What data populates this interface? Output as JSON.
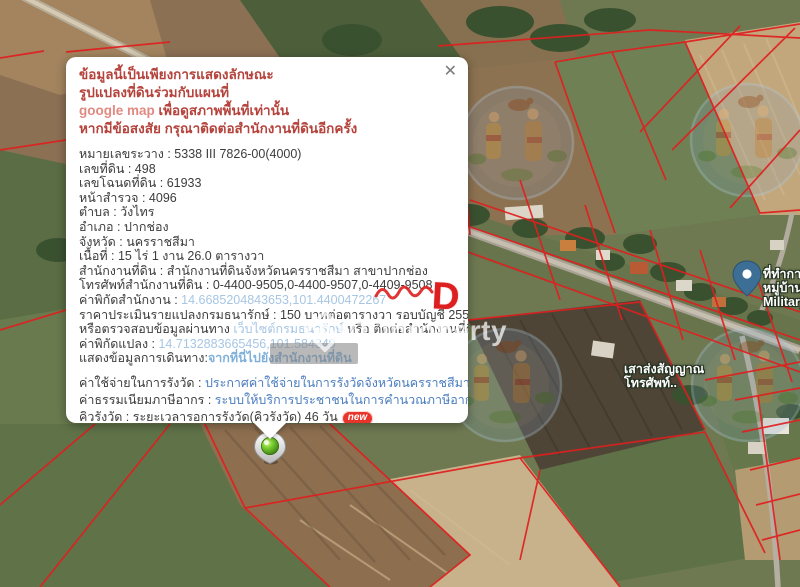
{
  "popup": {
    "close_label": "✕",
    "blocks": [
      {
        "name": "warning",
        "lines": [
          [
            {
              "t": "ข้อมูลนี้เป็นเพียงการแสดงลักษณะ",
              "s": "red"
            }
          ],
          [
            {
              "t": "รูปแปลงที่ดินร่วมกับแผนที่",
              "s": "red"
            }
          ],
          [
            {
              "t": "google map ",
              "s": "red-light"
            },
            {
              "t": "เพื่อดูสภาพพื้นที่เท่านั้น",
              "s": "red"
            }
          ],
          [
            {
              "t": "หากมีข้อสงสัย กรุณาติดต่อสำนักงานที่ดินอีกครั้ง",
              "s": "red"
            }
          ]
        ]
      },
      {
        "name": "details",
        "lines": [
          [
            {
              "t": "หมายเลขระวาง : 5338 III 7826-00(4000)"
            }
          ],
          [
            {
              "t": "เลขที่ดิน : 498"
            }
          ],
          [
            {
              "t": "เลขโฉนดที่ดิน : 61933"
            }
          ],
          [
            {
              "t": "หน้าสำรวจ : 4096"
            }
          ],
          [
            {
              "t": "ตำบล : วังไทร"
            }
          ],
          [
            {
              "t": "อำเภอ : ปากช่อง"
            }
          ],
          [
            {
              "t": "จังหวัด : นครราชสีมา"
            }
          ],
          [
            {
              "t": "เนื้อที่ : 15 ไร่ 1 งาน 26.0 ตารางวา"
            }
          ],
          [
            {
              "t": "สำนักงานที่ดิน : สำนักงานที่ดินจังหวัดนครราชสีมา สาขาปากช่อง"
            }
          ],
          [
            {
              "t": "โทรศัพท์สำนักงานที่ดิน : 0-4400-9505,0-4400-9507,0-4409-9508"
            }
          ],
          [
            {
              "t": "ค่าพิกัดสำนักงาน : "
            },
            {
              "t": "14.6685204843653,101.4400472267",
              "s": "link-light"
            }
          ],
          [
            {
              "t": "ราคาประเมินรายแปลงกรมธนารักษ์ : 150 บาทต่อตารางวา รอบบัญชี 2559-2562"
            }
          ],
          [
            {
              "t": "หรือตรวจสอบข้อมูลผ่านทาง "
            },
            {
              "t": "เว็บไซต์กรมธนารักษ์",
              "s": "link-light"
            },
            {
              "t": " หรือ ติดต่อสำนักงานที่ดิน"
            }
          ],
          [
            {
              "t": "ค่าพิกัดแปลง : "
            },
            {
              "t": "14.7132883665456,101.584349",
              "s": "link-light"
            }
          ],
          [
            {
              "t": "แสดงข้อมูลการเดินทาง:"
            },
            {
              "t": "จากที่นี่ไปยังสำนักงานที่ดิน",
              "s": "link-mid"
            }
          ]
        ]
      },
      {
        "name": "actions",
        "lines": [
          [
            {
              "t": "ค่าใช้จ่ายในการรังวัด : "
            },
            {
              "t": "ประกาศค่าใช้จ่ายในการรังวัดจังหวัดนครราชสีมา",
              "s": "link-blue"
            },
            {
              "t": "new",
              "s": "badge"
            }
          ],
          [
            {
              "t": "ค่าธรรมเนียมภาษีอากร : "
            },
            {
              "t": "ระบบให้บริการประชาชนในการคำนวณภาษีอากร",
              "s": "link-blue"
            },
            {
              "t": "new",
              "s": "badge"
            }
          ],
          [
            {
              "t": "คิวรังวัด : ระยะเวลารอการรังวัด(คิวรังวัด) 46 วัน"
            },
            {
              "t": "new",
              "s": "badge"
            }
          ]
        ]
      }
    ]
  },
  "map": {
    "labels": [
      {
        "name": "military-village-office-label",
        "x": 763,
        "y": 267,
        "lines": [
          "ที่ทำการ",
          "หมู่บ้าน",
          "Military"
        ]
      },
      {
        "name": "telephone-tower-label",
        "x": 624,
        "y": 362,
        "lines": [
          "เสาส่งสัญญาณ",
          "โทรศัพท์.."
        ]
      }
    ],
    "colors": {
      "parcel_line": "#e01f1f",
      "link_light": "#a6c6e4",
      "link_blue": "#4a7dbf",
      "warning_red": "#b5433c",
      "badge_red": "#e8352c"
    }
  },
  "watermark": {
    "brand": "DDproperty"
  },
  "annotation": {
    "letter": "D"
  }
}
